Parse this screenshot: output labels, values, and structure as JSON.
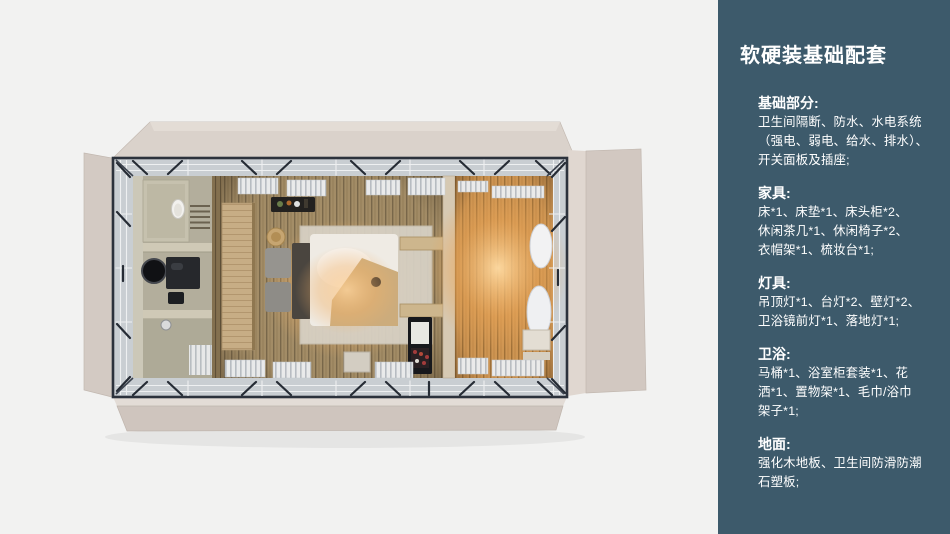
{
  "panel": {
    "title": "软硬装基础配套",
    "sections": [
      {
        "heading": "基础部分:",
        "body": "卫生间隔断、防水、水电系统\n（强电、弱电、给水、排水）、\n开关面板及插座;"
      },
      {
        "heading": "家具:",
        "body": "床*1、床垫*1、床头柜*2、\n休闲茶几*1、休闲椅子*2、\n衣帽架*1、梳妆台*1;"
      },
      {
        "heading": "灯具:",
        "body": "吊顶灯*1、台灯*2、壁灯*2、\n卫浴镜前灯*1、落地灯*1;"
      },
      {
        "heading": "卫浴:",
        "body": "马桶*1、浴室柜套装*1、花\n洒*1、置物架*1、毛巾/浴巾\n架子*1;"
      },
      {
        "heading": "地面:",
        "body": "强化木地板、卫生间防滑防潮\n石塑板;"
      }
    ]
  },
  "floorplan": {
    "colors": {
      "panel_bg": "#3d5a6b",
      "panel_text": "#ffffff",
      "canvas_bg": "#f2f2f1",
      "flap_beige": "#d5ccc5",
      "steel_frame": "#2c323c",
      "glass_band": "#c9ced2",
      "wood_floor": "#a8916a",
      "warm_floor": "#d59a55",
      "bathroom_floor": "#b3ae9c",
      "lamp_glow": "#f2b269"
    }
  }
}
